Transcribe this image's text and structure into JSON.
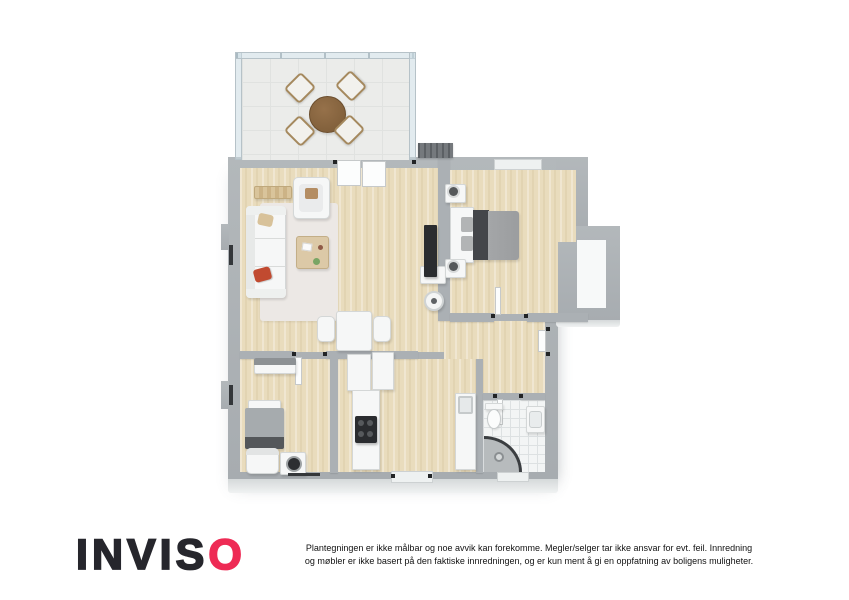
{
  "branding": {
    "logo_prefix": "INVIS",
    "logo_accent_letter": "O",
    "logo_color": "#26262c",
    "logo_accent_color": "#ee2b55"
  },
  "disclaimer": {
    "line1": "Plantegningen er ikke målbar og noe avvik kan forekomme. Megler/selger tar ikke ansvar for evt. feil. Innredning",
    "line2": "og møbler er ikke basert på den faktiske innredningen, og er kun ment å gi en oppfatning av boligens muligheter."
  },
  "palette": {
    "wall_gray": "#a9aeb2",
    "wood_floor": "#e9dcbd",
    "balcony_tile": "#ebecea",
    "bathroom_tile": "#f3f5f5",
    "glass": "#cbdae2",
    "accent_red_pillow": "#c14a30",
    "dark_furniture": "#2a2c2f"
  },
  "floor_plan": {
    "type": "3d-top-down-floor-plan",
    "rooms": [
      {
        "id": "balcony",
        "floor": "light-tile",
        "features": [
          "glass-railing",
          "round-dining-table",
          "four-chairs"
        ]
      },
      {
        "id": "living-room",
        "floor": "wood",
        "features": [
          "sofa",
          "armchair",
          "coffee-table",
          "rug",
          "tv",
          "small-table-two-chairs",
          "sideboard"
        ]
      },
      {
        "id": "main-bedroom",
        "floor": "wood",
        "features": [
          "double-bed",
          "two-nightstands",
          "headboard-console",
          "bay-niche"
        ]
      },
      {
        "id": "hallway",
        "floor": "wood",
        "features": []
      },
      {
        "id": "second-bedroom",
        "floor": "wood",
        "features": [
          "single-bed",
          "chair",
          "washing-machine",
          "dresser"
        ]
      },
      {
        "id": "kitchen",
        "floor": "wood",
        "features": [
          "tall-cabinets",
          "counter-with-cooktop",
          "counter-with-sink"
        ]
      },
      {
        "id": "bathroom",
        "floor": "white-tile",
        "features": [
          "toilet",
          "vanity-sink",
          "corner-shower"
        ]
      }
    ]
  }
}
